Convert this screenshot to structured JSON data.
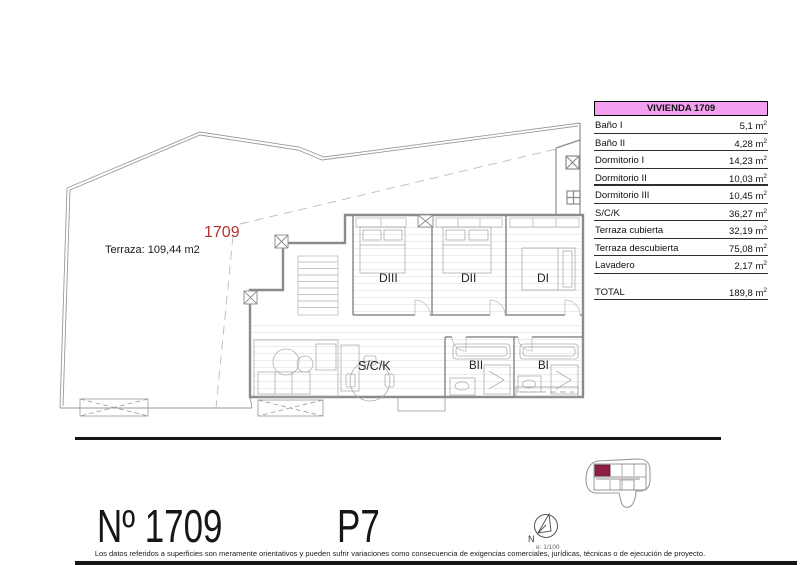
{
  "colors": {
    "table_header_bg": "#f2a0ef",
    "unit_red": "#b03030",
    "locator_highlight": "#8e2044",
    "line_black": "#151515"
  },
  "plan": {
    "unit_label": "1709",
    "terrace_label": "Terraza: 109,44 m2",
    "rooms": {
      "diii": "DIII",
      "dii": "DII",
      "di": "DI",
      "sck": "S/C/K",
      "bii": "BII",
      "bi": "BI"
    }
  },
  "table": {
    "title": "VIVIENDA 1709",
    "unit_suffix": "m",
    "unit_sup": "2",
    "rows": [
      {
        "label": "Baño I",
        "value": "5,1"
      },
      {
        "label": "Baño II",
        "value": "4,28"
      },
      {
        "label": "Dormitorio I",
        "value": "14,23"
      },
      {
        "label": "Dormitorio II",
        "value": "10,03"
      },
      {
        "label": "Dormitorio III",
        "value": "10,45"
      },
      {
        "label": "S/C/K",
        "value": "36,27"
      },
      {
        "label": "Terraza cubierta",
        "value": "32,19"
      },
      {
        "label": "Terraza descubierta",
        "value": "75,08"
      },
      {
        "label": "Lavadero",
        "value": "2,17"
      }
    ],
    "total_label": "TOTAL",
    "total_value": "189,8"
  },
  "footer": {
    "unit_number": "Nº 1709",
    "floor": "P7",
    "compass_n": "N",
    "scale": "e: 1/100",
    "disclaimer": "Los datos referidos a superficies son meramente orientativos y pueden sufrir variaciones como consecuencia de exigencias comerciales, jurídicas, técnicas o de ejecución de proyecto."
  }
}
